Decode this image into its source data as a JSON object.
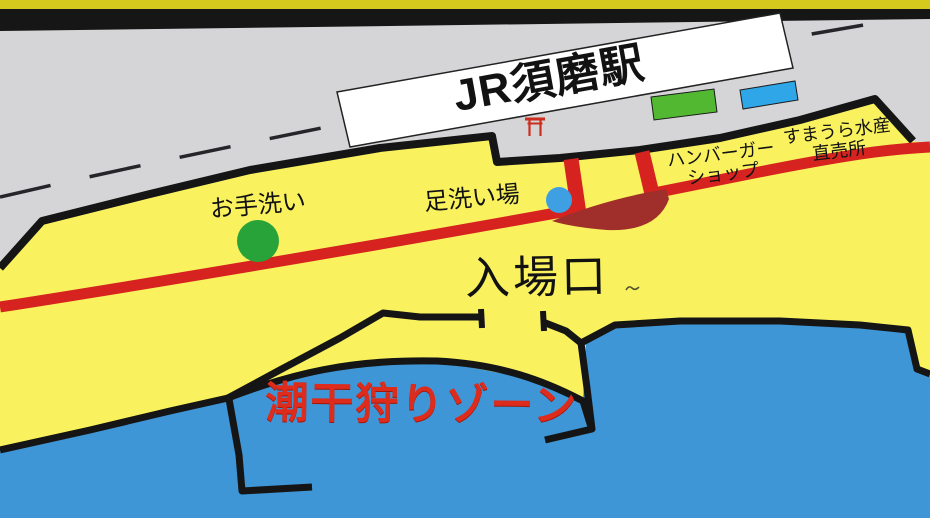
{
  "map": {
    "station_label": "JR須磨駅",
    "labels": {
      "fishshop_line1": "すまうら水産",
      "fishshop_line2": "直売所",
      "hamburger_line1": "ハンバーガー",
      "hamburger_line2": "ショップ",
      "restroom": "お手洗い",
      "foot_washing": "足洗い場",
      "entrance": "入場口",
      "clam_zone": "潮干狩りゾーン"
    },
    "colors": {
      "land": "#f9f25e",
      "sea": "#3e96d6",
      "station_gray": "#d5d5d7",
      "top_strip": "#d6c91d",
      "band_black": "#161616",
      "road_red": "#d6231f",
      "plaza_dark_red": "#a02e2a",
      "restroom_marker": "#27a33a",
      "foot_wash_marker": "#3e9fe2",
      "building_green": "#52b832",
      "building_blue": "#2fa6e8",
      "station_building": "#ffffff",
      "zone_text": "#dd2b1c",
      "torii_red": "#cc2d1e"
    }
  }
}
